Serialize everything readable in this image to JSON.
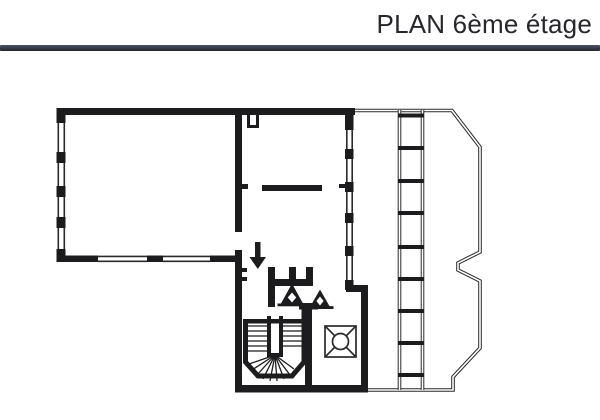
{
  "header": {
    "title": "PLAN 6ème étage"
  },
  "colors": {
    "paper": "#ffffff",
    "ink": "#1c1c1e",
    "title_text": "#26262b",
    "divider_top": "#4a505e",
    "divider_bottom": "#22262e"
  },
  "plan": {
    "name": "floor-plan-6th-floor",
    "symbols": [
      "down-arrow-icon",
      "elevator-icon",
      "vent-shaft-triangle-icon",
      "winder-staircase",
      "balcony-ladder",
      "window-wall"
    ]
  }
}
